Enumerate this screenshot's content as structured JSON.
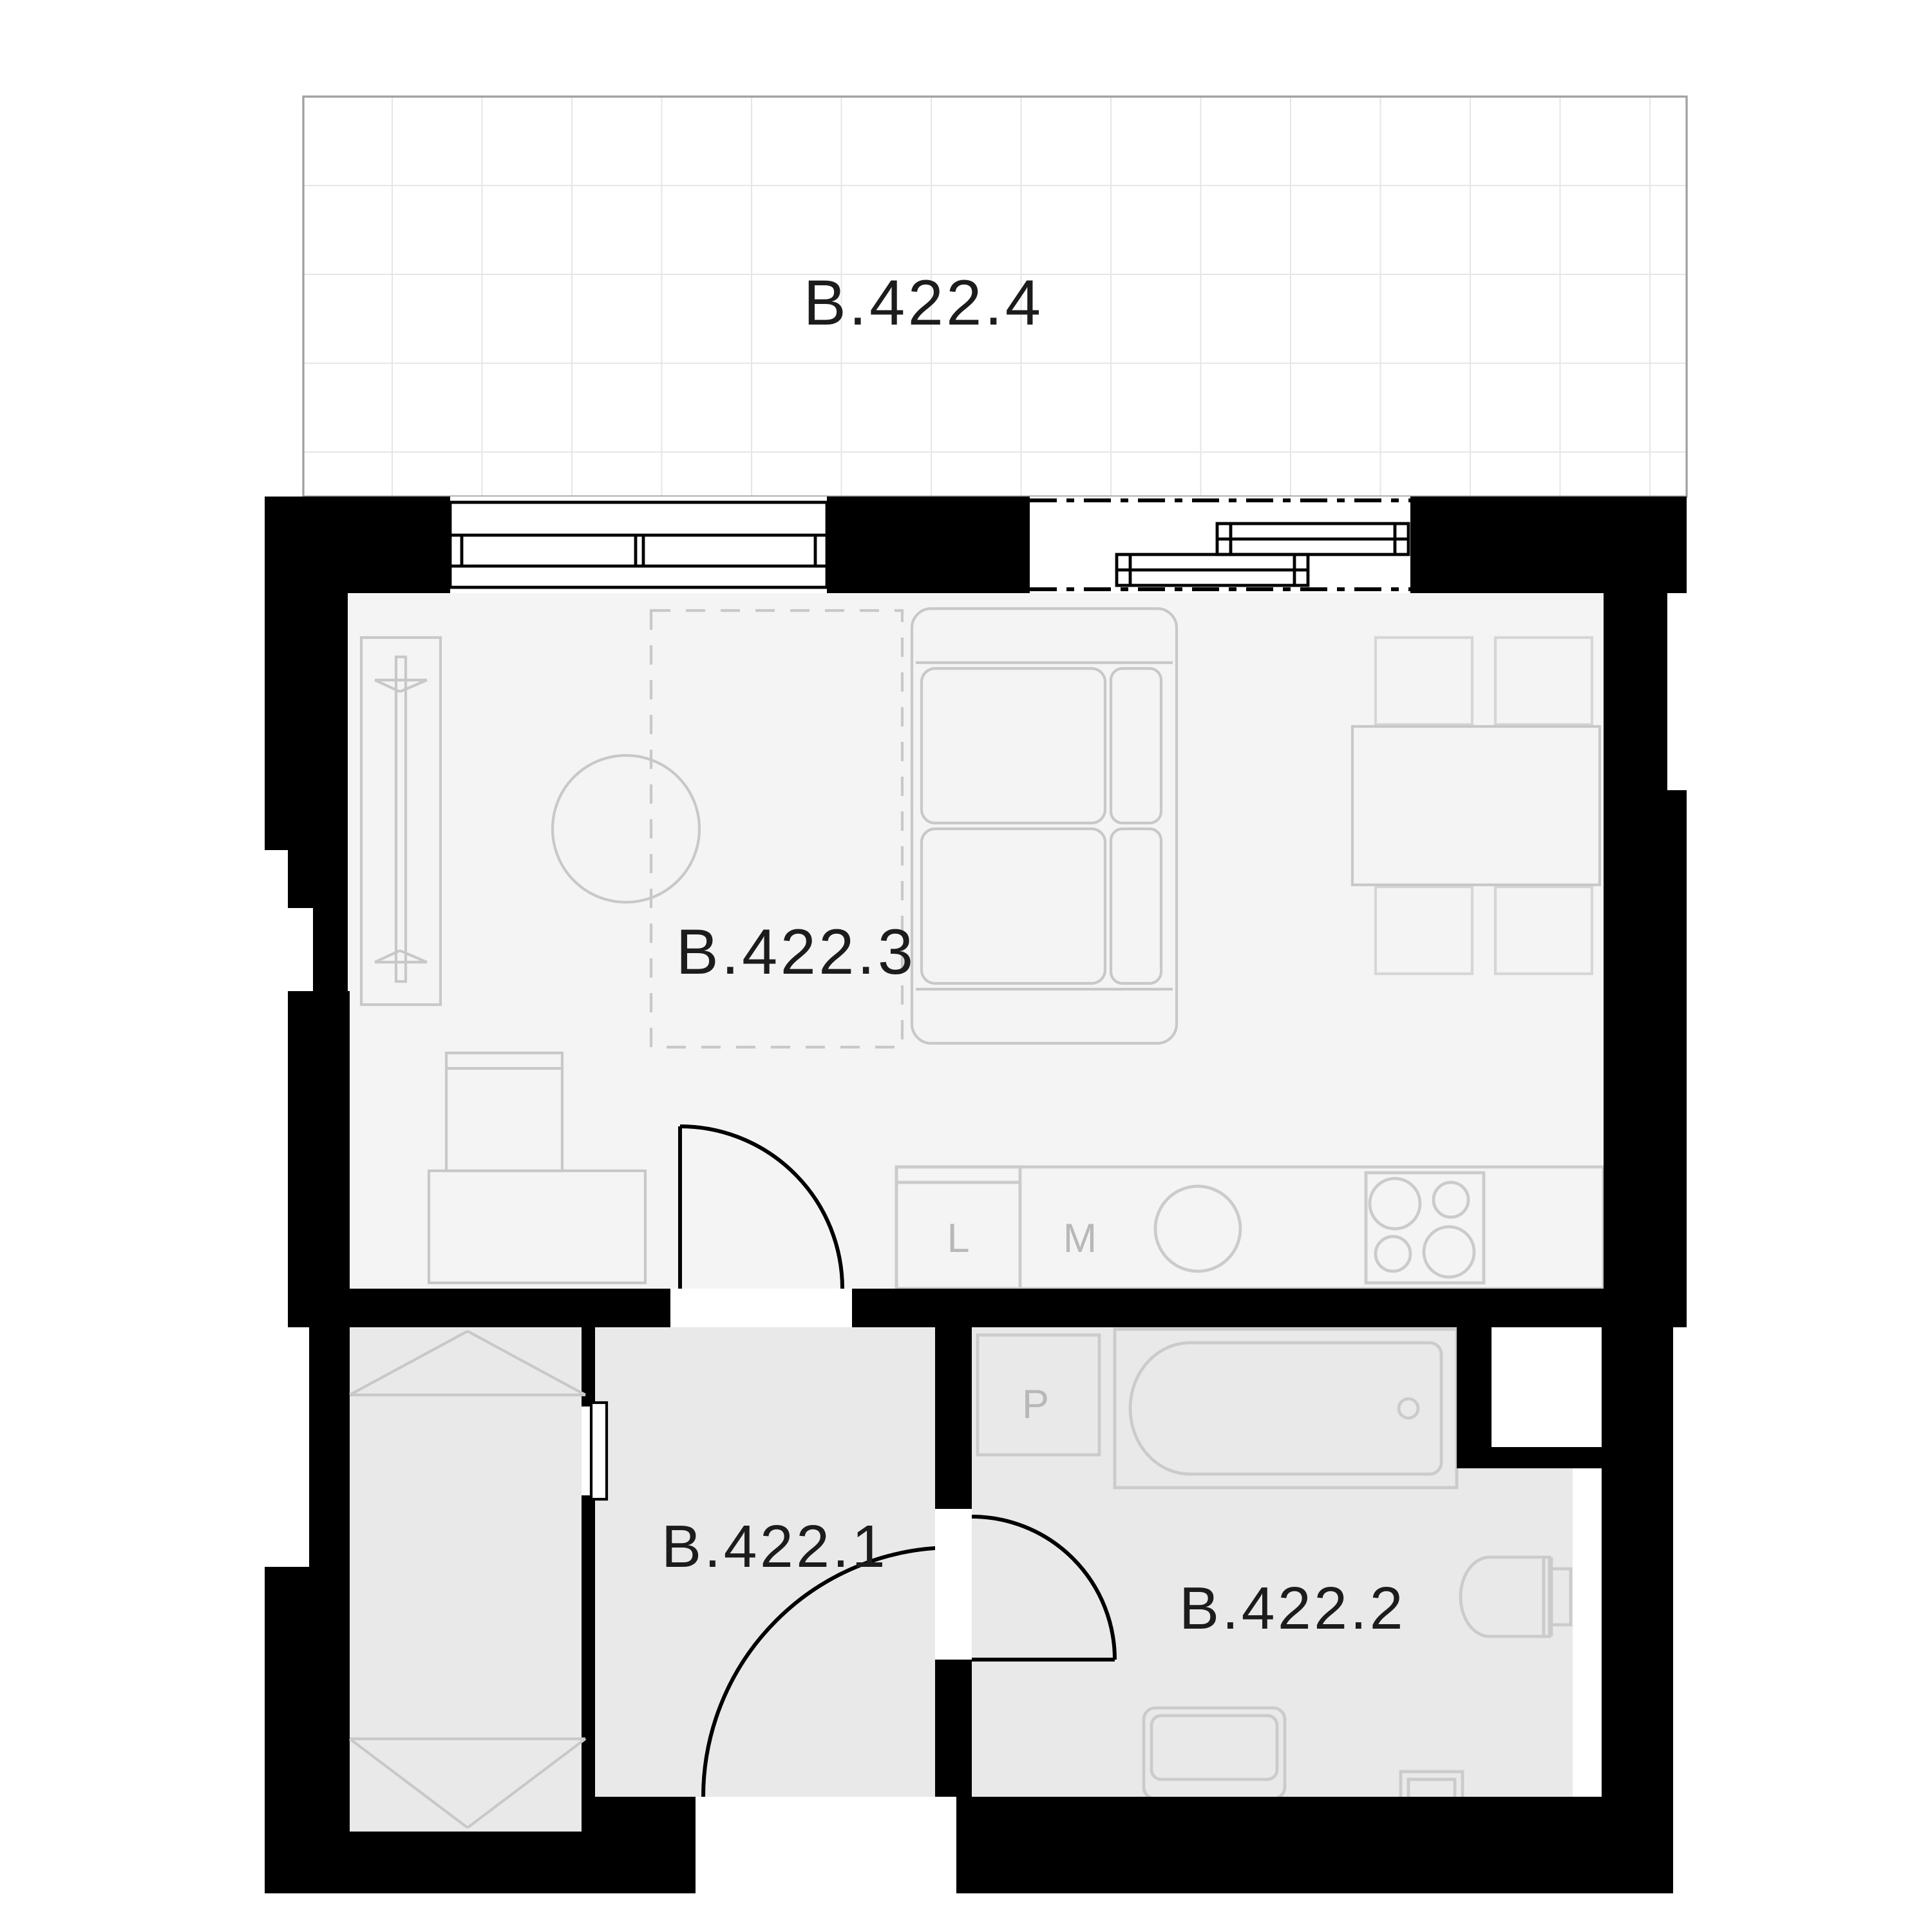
{
  "title": "Floor plan unit B.422",
  "colors": {
    "wall": "#000000",
    "floor_living": "#f4f4f4",
    "floor_service": "#e9e9e9",
    "furniture": "#c8c8c8",
    "furniture_light": "#d6d6d6",
    "fixture": "#cbcbcb",
    "door": "#000000",
    "label_dark": "#1c1c1c",
    "label_light": "#b8b8b8",
    "balcony_grid": "#e6e6e6",
    "balcony_border": "#a0a0a0"
  },
  "rooms": [
    {
      "id": "terrace",
      "label": "B.422.4",
      "type": "terrace"
    },
    {
      "id": "living_kitchen",
      "label": "B.422.3",
      "type": "living room with kitchen"
    },
    {
      "id": "hallway",
      "label": "B.422.1",
      "type": "entrance hall"
    },
    {
      "id": "bathroom",
      "label": "B.422.2",
      "type": "bathroom"
    }
  ],
  "labels": {
    "terrace": "B.422.4",
    "living": "B.422.3",
    "hallway": "B.422.1",
    "bathroom": "B.422.2"
  },
  "appliances": {
    "dishwasher": "L",
    "fridge": "M",
    "washer": "P"
  }
}
